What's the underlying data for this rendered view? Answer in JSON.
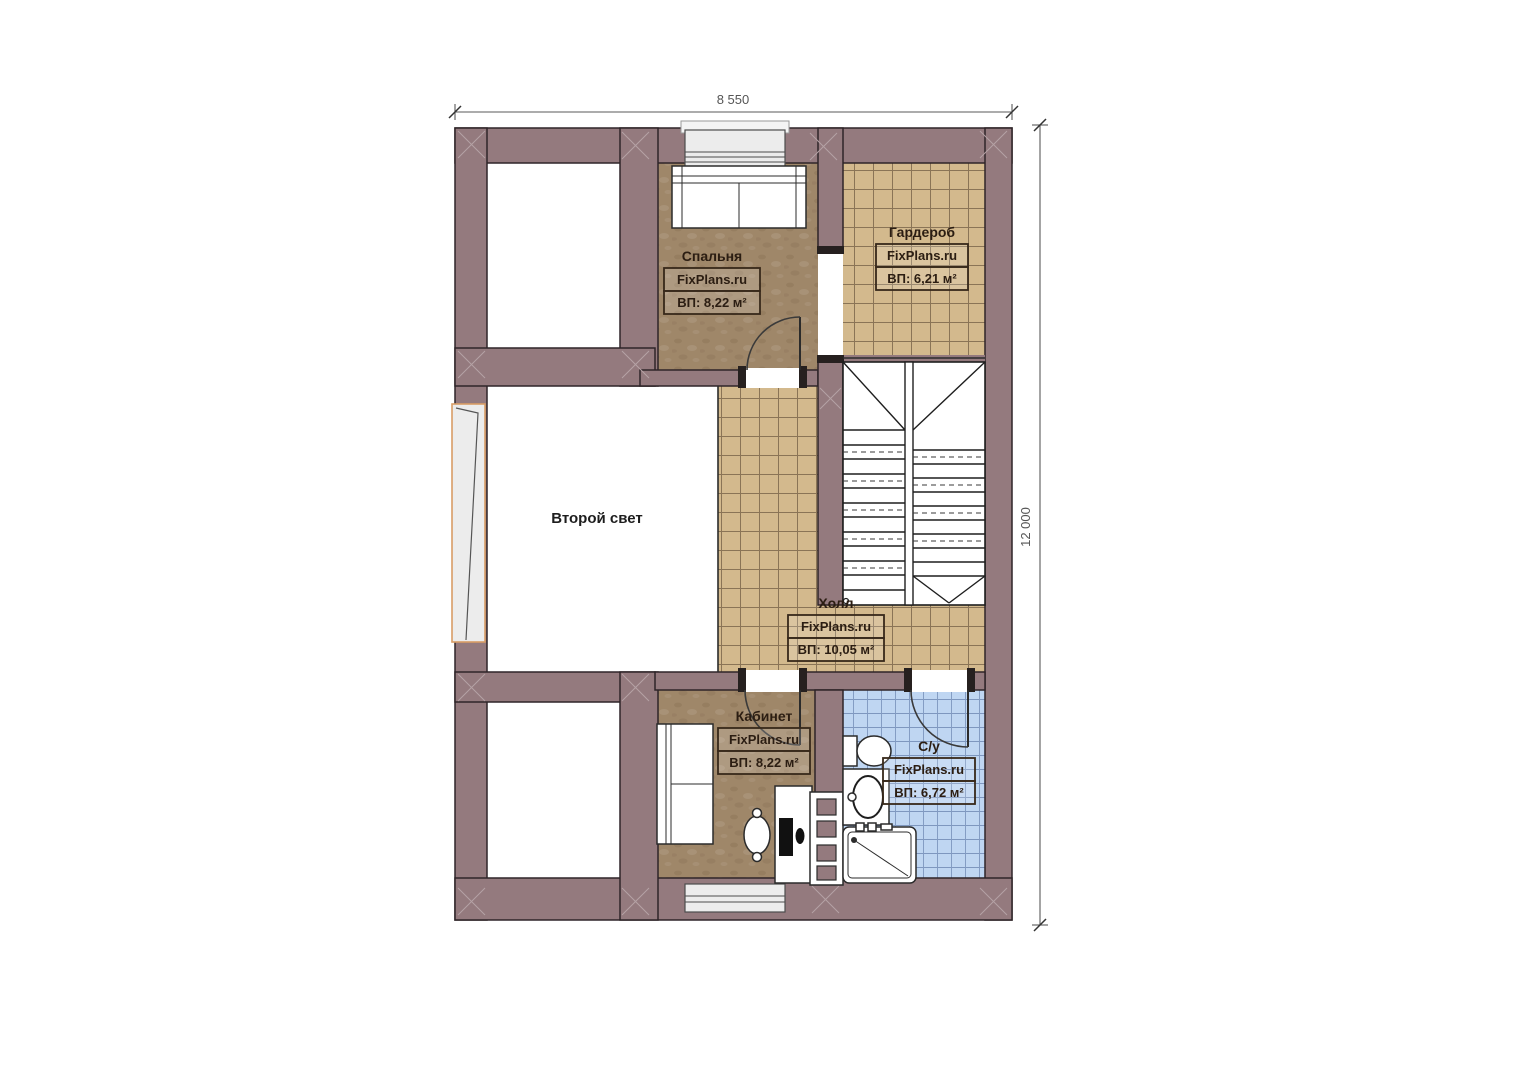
{
  "plan": {
    "type": "second-floor-plan",
    "watermark": "FixPlans.ru",
    "dimensions": {
      "width_label": "8 550",
      "height_label": "12 000"
    },
    "rooms": {
      "bedroom": {
        "name": "Спальня",
        "site": "FixPlans.ru",
        "area": "ВП: 8,22 м²"
      },
      "wardrobe": {
        "name": "Гардероб",
        "site": "FixPlans.ru",
        "area": "ВП: 6,21 м²"
      },
      "void": {
        "name": "Второй свет"
      },
      "hall": {
        "name": "Холл",
        "site": "FixPlans.ru",
        "area": "ВП: 10,05 м²"
      },
      "office": {
        "name": "Кабинет",
        "site": "FixPlans.ru",
        "area": "ВП: 8,22 м²"
      },
      "bathroom": {
        "name": "С/у",
        "site": "FixPlans.ru",
        "area": "ВП: 6,72 м²"
      }
    },
    "colors": {
      "wall": "#947a7e",
      "wood_floor": "#9f8769",
      "tile_floor": "#d3b98d",
      "bath_tile": "#bfd6f2",
      "window_accent": "#d99d66"
    }
  }
}
